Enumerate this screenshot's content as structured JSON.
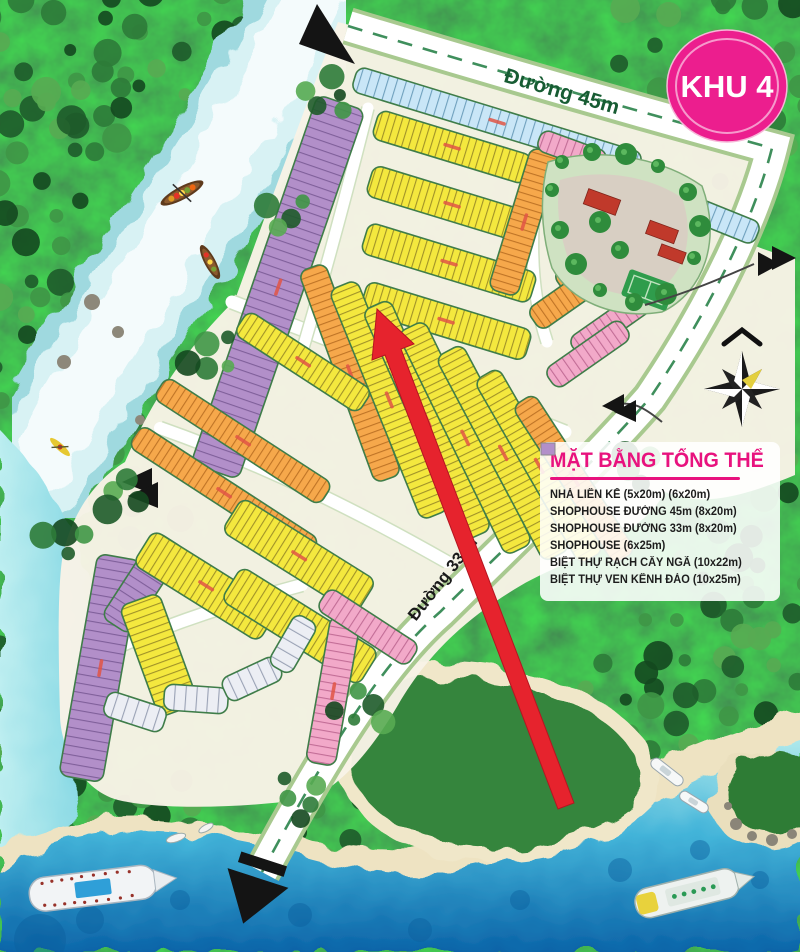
{
  "badge": {
    "label": "KHU 4",
    "color": "#ec1e8e",
    "text_color": "#ffffff"
  },
  "roads": {
    "road_45_label": "Đường 45m",
    "road_33_label": "Đường 33 m"
  },
  "legend": {
    "title": "MẶT BẰNG TỔNG THỂ",
    "accent_color": "#e8127e",
    "items": [
      {
        "label": "NHÀ LIÊN KẾ (5x20m) (6x20m)",
        "color": "#f4e83e"
      },
      {
        "label": "SHOPHOUSE ĐƯỜNG 45m (8x20m)",
        "color": "#c9e6f7"
      },
      {
        "label": "SHOPHOUSE ĐƯỜNG 33m (8x20m)",
        "color": "#f2a9c9"
      },
      {
        "label": "SHOPHOUSE (6x25m)",
        "color": "#f6a84b"
      },
      {
        "label": "BIỆT THỰ RẠCH CÂY NGÃ (10x22m)",
        "color": "#eceef4"
      },
      {
        "label": "BIỆT THỰ VEN KÊNH ĐÀO (10x25m)",
        "color": "#b28fc9"
      }
    ]
  },
  "annotations": {
    "highlight_arrow_color": "#e6232d",
    "compass_icon": "compass-rose-icon"
  }
}
